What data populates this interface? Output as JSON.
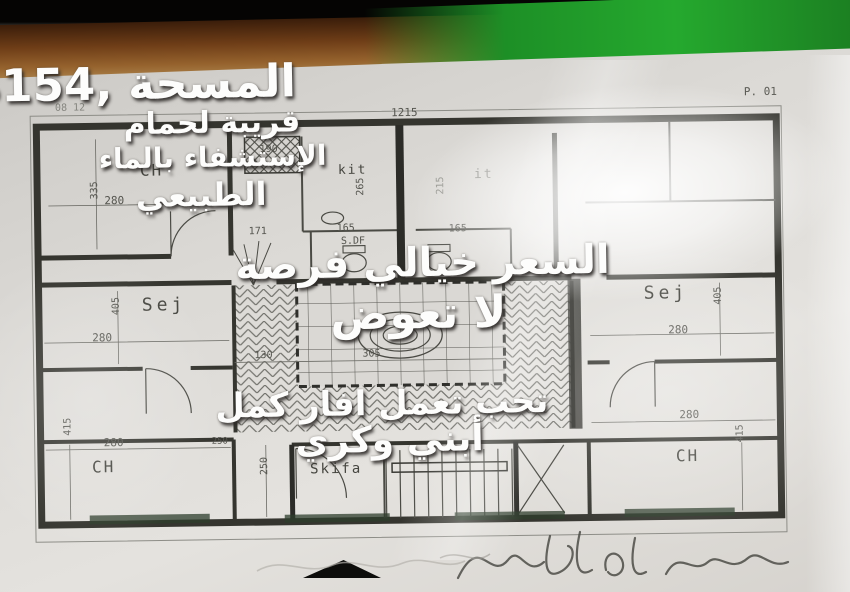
{
  "overlay": {
    "line1": "المسحة ,154م",
    "line2": "قريبة لحمام",
    "line3": "الإستشفاء بالماء",
    "line4": "الطبيعي",
    "line5": "السعر خيالي فرصة",
    "line6": "لا تعوض",
    "line7": "تحب تعمل افار كمل",
    "line8": "أبني وكري"
  },
  "sheet": {
    "page_no": "P. 01",
    "header_note": "08 12",
    "top_dim": "1215"
  },
  "rooms": {
    "ch_top_left": "CH",
    "kit_left": "kit",
    "kit_right": "it",
    "bath": "S.DF",
    "sej_left": "Sej",
    "sej_right": "Sej",
    "ch_bottom_left": "CH",
    "skifa": "Skifa",
    "ch_bottom_right": "CH"
  },
  "dims": {
    "hatch_box": "190",
    "ch_tl_h": "335",
    "ch_tl_w": "280",
    "kit_left_h": "265",
    "kit_right_h": "215",
    "bath_left": "165",
    "bath_right": "165",
    "hall": "171",
    "sej_left_h": "405",
    "sej_left_w": "280",
    "sej_right_h": "405",
    "sej_right_w": "280",
    "gallery_w": "130",
    "court_w": "305",
    "ch_bl_w": "280",
    "ch_bl_h": "415",
    "corridor_h": "250",
    "skifa_top": "250",
    "ch_br_w": "280",
    "ch_br_h": "415"
  },
  "colors": {
    "paper": "#dcdad6",
    "wood": "#8a5a28",
    "green_edge": "#25a92e",
    "pencil": "#3a3a35",
    "overlay_text": "#fdfdfc"
  }
}
